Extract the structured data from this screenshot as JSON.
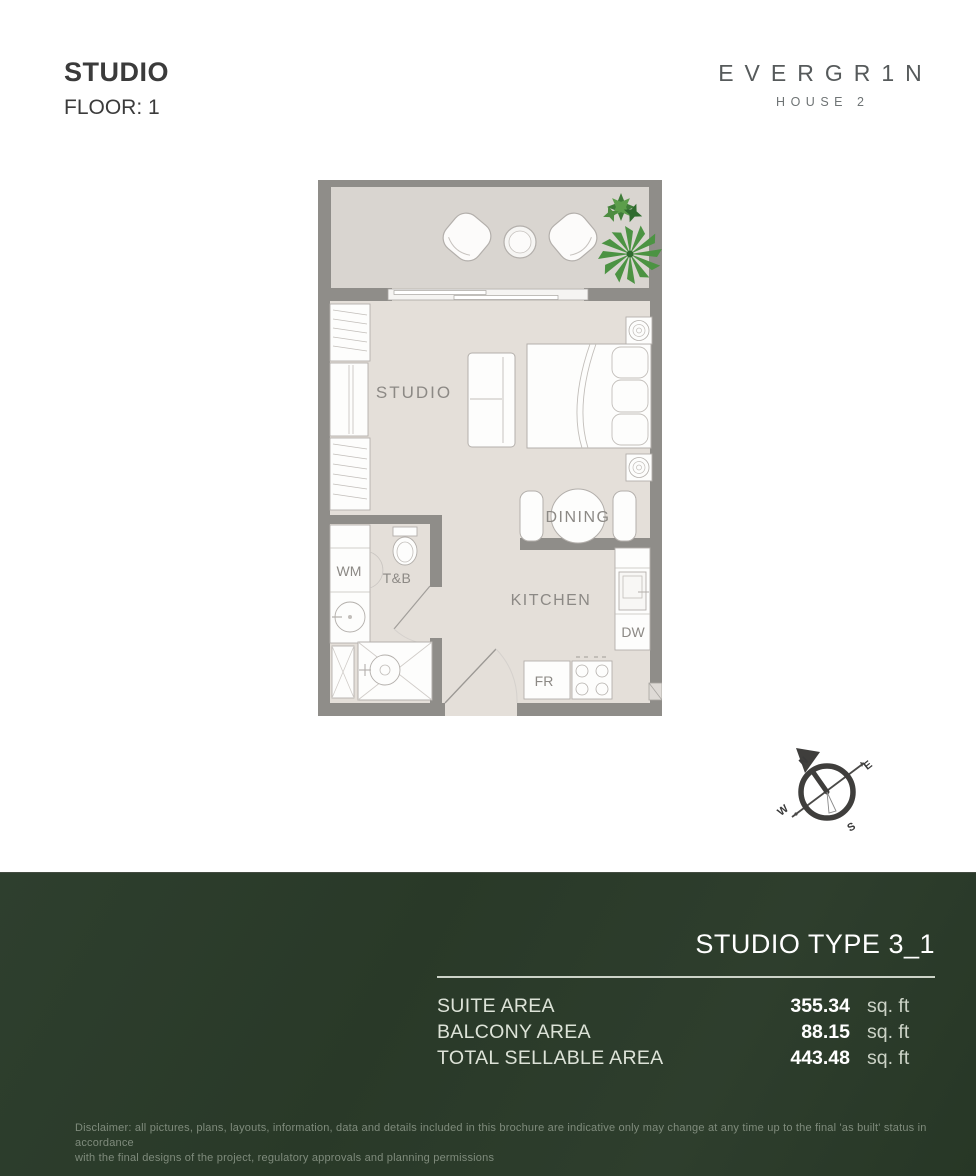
{
  "header": {
    "title": "STUDIO",
    "floor": "FLOOR: 1"
  },
  "brand": {
    "name": "EVERGR1N",
    "subtitle": "HOUSE 2"
  },
  "floorplan": {
    "labels": {
      "studio": "STUDIO",
      "dining": "DINING",
      "kitchen": "KITCHEN",
      "tb": "T&B",
      "wm": "WM",
      "dw": "DW",
      "fr": "FR"
    }
  },
  "compass": {
    "n": "N",
    "e": "E",
    "w": "W",
    "s": "S"
  },
  "summary": {
    "heading": "STUDIO TYPE 3_1",
    "rows": [
      {
        "label": "SUITE AREA",
        "value": "355.34",
        "unit": "sq. ft"
      },
      {
        "label": "BALCONY AREA",
        "value": "88.15",
        "unit": "sq. ft"
      },
      {
        "label": "TOTAL SELLABLE AREA",
        "value": "443.48",
        "unit": "sq. ft"
      }
    ]
  },
  "disclaimer": {
    "line1": "Disclaimer: all pictures, plans, layouts, information, data and details included in this brochure are indicative only may change at any time up to the final 'as built' status in accordance",
    "line2": "with the final designs of the project, regulatory approvals and planning permissions"
  },
  "colors": {
    "panel_green": "#2a3a29",
    "rule_light": "#ccd3c8",
    "wall_gray": "#8f8d89",
    "floor_interior": "#e4dfd9",
    "floor_balcony": "#d9d5d0",
    "furniture_stroke": "#b3afab",
    "plant_green_dark": "#3e7c38",
    "plant_green_light": "#5c9e4b",
    "text_dark": "#3b3b3b"
  }
}
